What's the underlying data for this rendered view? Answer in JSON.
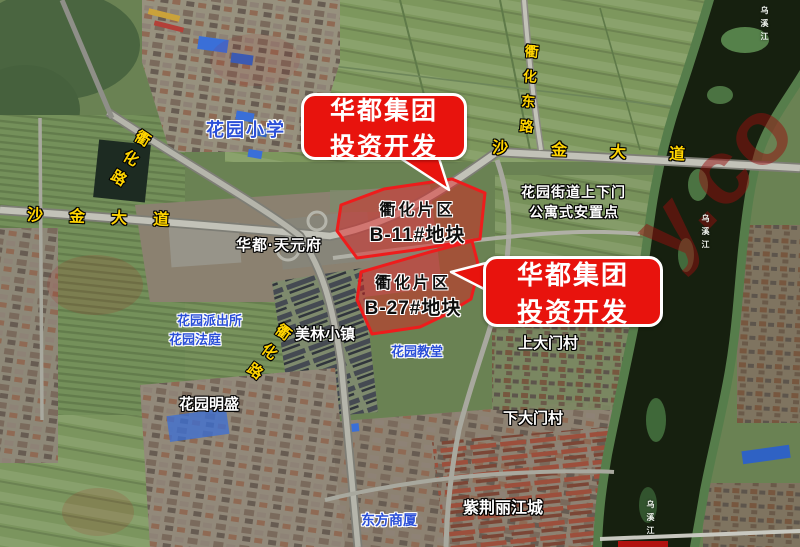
{
  "colors": {
    "callout_red": "#e8130d",
    "plot_fill_red": "#e51a1a",
    "road_label_yellow": "#ffd400",
    "place_label_blue": "#2b4fd8",
    "place_label_white": "#ffffff",
    "plot_label_black": "#0d0d0d",
    "river_dark": "#16200f",
    "watermark_red": "#941414"
  },
  "callouts": [
    {
      "id": "b11",
      "line1": "华都集团",
      "line2": "投资开发"
    },
    {
      "id": "b27",
      "line1": "华都集团",
      "line2": "投资开发"
    }
  ],
  "plots": [
    {
      "id": "B-11",
      "line1": "衢化片区",
      "line2": "B-11#地块"
    },
    {
      "id": "B-27",
      "line1": "衢化片区",
      "line2": "B-27#地块"
    }
  ],
  "road_labels": {
    "quhua_road_top": "衢化路",
    "shajin_avenue_left": "沙金大道",
    "shajin_avenue_right": "沙金大道",
    "quhua_east_road": "衢化东路",
    "quhua_road_mid": "衢化路"
  },
  "place_labels": {
    "huayuan_primary_school": "花园小学",
    "huadu_tianyuanfu": "华都·天元府",
    "resettlement_line1": "花园街道上下门",
    "resettlement_line2": "公寓式安置点",
    "huayuan_police_station": "花园派出所",
    "huayuan_court": "花园法庭",
    "meilin_town": "美林小镇",
    "huayuan_church": "花园教堂",
    "shangdamen_village": "上大门村",
    "huayuan_mingsheng": "花园明盛",
    "xiadamen_village": "下大门村",
    "zijin_lijiang_city": "紫荆丽江城",
    "dongfang_shangsha": "东方商厦"
  },
  "river_labels": [
    "乌溪江",
    "乌溪江",
    "乌溪江"
  ],
  "watermark": "y.co"
}
